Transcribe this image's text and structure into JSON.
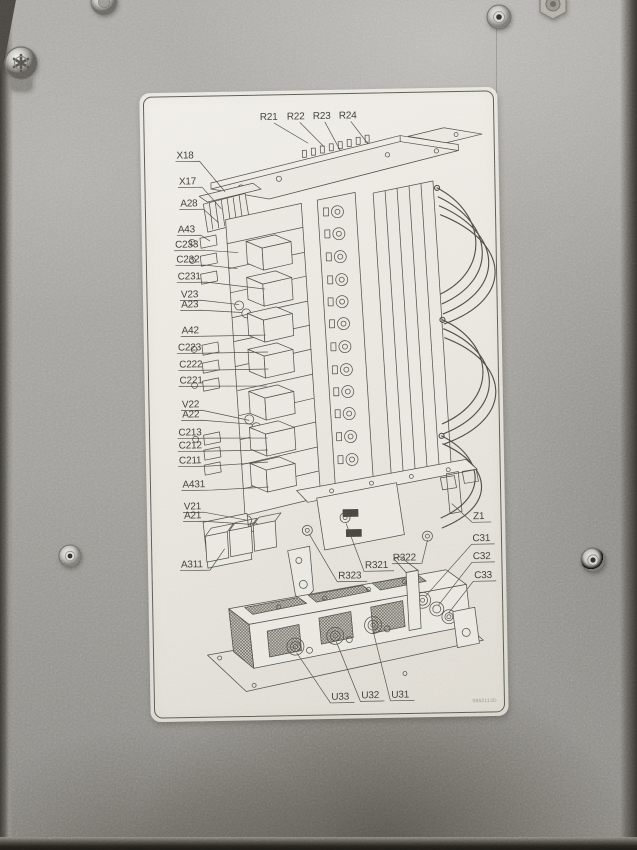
{
  "scene": {
    "description": "photograph of a galvanized steel equipment panel with a printed isometric component-location diagram label",
    "colors": {
      "metal": "#a7a5a0",
      "metal_edge": "#37342f",
      "label_paper": "#eae7e0",
      "ink": "#45443e",
      "callout_text": "#3b3a35"
    }
  },
  "diagram": {
    "part_code": "9862113D",
    "callouts": [
      {
        "t": "R21",
        "x": 129,
        "y": 29,
        "a": "m",
        "pts": "134,32 168,53"
      },
      {
        "t": "R22",
        "x": 156,
        "y": 29,
        "a": "m",
        "pts": "160,32 184,57"
      },
      {
        "t": "R23",
        "x": 182,
        "y": 29,
        "a": "m",
        "pts": "185,32 200,61"
      },
      {
        "t": "R24",
        "x": 208,
        "y": 29,
        "a": "m",
        "pts": "211,32 228,55"
      },
      {
        "t": "X18",
        "x": 36,
        "y": 66,
        "a": "s",
        "pts": "35,69 59,69 84,100"
      },
      {
        "t": "X17",
        "x": 38,
        "y": 92,
        "a": "s",
        "pts": "37,95 61,95 80,117"
      },
      {
        "t": "A28",
        "x": 39,
        "y": 114,
        "a": "s",
        "pts": "38,117 62,117 77,131"
      },
      {
        "t": "A43",
        "x": 36,
        "y": 140,
        "a": "s",
        "pts": "35,143 59,143 68,149"
      },
      {
        "t": "C233",
        "x": 33,
        "y": 155,
        "a": "s",
        "pts": "32,158 62,158 96,161"
      },
      {
        "t": "C232",
        "x": 34,
        "y": 170,
        "a": "s",
        "pts": "33,173 63,173 95,177"
      },
      {
        "t": "C231",
        "x": 35,
        "y": 187,
        "a": "s",
        "pts": "34,190 64,190 122,198"
      },
      {
        "t": "V23",
        "x": 38,
        "y": 205,
        "a": "s",
        "pts": "37,208 58,208 96,213"
      },
      {
        "t": "A23",
        "x": 38,
        "y": 215,
        "a": "s",
        "pts": "37,218 58,218 99,221"
      },
      {
        "t": "A42",
        "x": 38,
        "y": 241,
        "a": "s",
        "pts": "37,244 58,244 122,244"
      },
      {
        "t": "C223",
        "x": 34,
        "y": 258,
        "a": "s",
        "pts": "33,261 63,261 124,261"
      },
      {
        "t": "C222",
        "x": 35,
        "y": 275,
        "a": "s",
        "pts": "34,278 64,278 124,278"
      },
      {
        "t": "C221",
        "x": 35,
        "y": 291,
        "a": "s",
        "pts": "34,294 64,294 122,295"
      },
      {
        "t": "V22",
        "x": 37,
        "y": 315,
        "a": "s",
        "pts": "36,318 57,318 104,329"
      },
      {
        "t": "A22",
        "x": 37,
        "y": 325,
        "a": "s",
        "pts": "36,328 57,328 107,333"
      },
      {
        "t": "C213",
        "x": 33,
        "y": 343,
        "a": "s",
        "pts": "32,346 62,346 122,347"
      },
      {
        "t": "C212",
        "x": 33,
        "y": 356,
        "a": "s",
        "pts": "32,359 62,359 122,359"
      },
      {
        "t": "C211",
        "x": 33,
        "y": 371,
        "a": "s",
        "pts": "32,374 62,374 122,371"
      },
      {
        "t": "A431",
        "x": 36,
        "y": 395,
        "a": "s",
        "pts": "35,398 65,398 122,396"
      },
      {
        "t": "V21",
        "x": 37,
        "y": 417,
        "a": "s",
        "pts": "36,420 57,420 101,429"
      },
      {
        "t": "A21",
        "x": 37,
        "y": 426,
        "a": "s",
        "pts": "36,429 57,429 104,433"
      },
      {
        "t": "A311",
        "x": 33,
        "y": 475,
        "a": "s",
        "pts": "32,478 62,478 77,457"
      },
      {
        "t": "R323",
        "x": 190,
        "y": 489,
        "a": "s",
        "pts": "219,492 189,492 162,444"
      },
      {
        "t": "R321",
        "x": 217,
        "y": 479,
        "a": "s",
        "pts": "246,482 216,482 199,434"
      },
      {
        "t": "R322",
        "x": 245,
        "y": 472,
        "a": "s",
        "pts": "244,475 274,475 280,452"
      },
      {
        "t": "Z1",
        "x": 326,
        "y": 432,
        "a": "s",
        "pts": "344,435 325,435 305,416"
      },
      {
        "t": "C31",
        "x": 325,
        "y": 454,
        "a": "s",
        "pts": "347,457 324,457 277,508"
      },
      {
        "t": "C32",
        "x": 325,
        "y": 472,
        "a": "s",
        "pts": "347,475 324,475 290,517"
      },
      {
        "t": "C33",
        "x": 326,
        "y": 491,
        "a": "s",
        "pts": "348,494 325,494 300,525"
      },
      {
        "t": "U33",
        "x": 181,
        "y": 610,
        "a": "s",
        "pts": "204,613 180,613 147,562"
      },
      {
        "t": "U32",
        "x": 211,
        "y": 609,
        "a": "s",
        "pts": "234,612 210,612 187,552"
      },
      {
        "t": "U31",
        "x": 241,
        "y": 609,
        "a": "s",
        "pts": "264,612 240,612 224,542"
      }
    ]
  }
}
